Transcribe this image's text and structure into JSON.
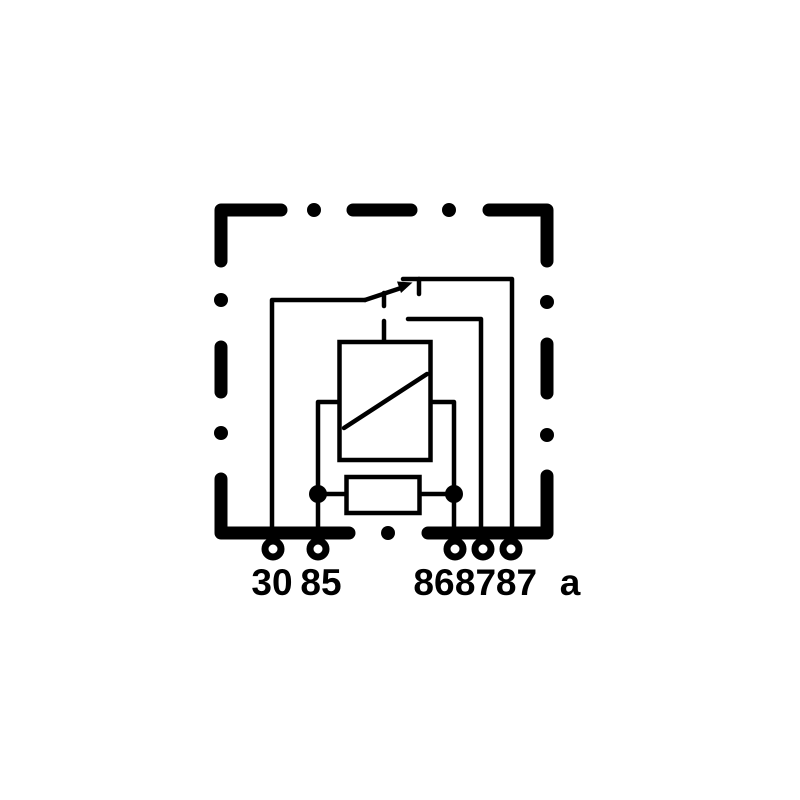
{
  "diagram": {
    "kind": "automotive-relay-wiring-diagram",
    "colors": {
      "line": "#000000",
      "background": "#ffffff"
    },
    "components": {
      "housing": "dashed-relay-housing-outline",
      "coil": "relay-coil-box-with-diagonal",
      "resistor": "parallel-resistor-box",
      "switch": "changeover-switch-contact",
      "pins": "terminal-pin-rings"
    },
    "terminals": [
      {
        "label": "30"
      },
      {
        "label": "85"
      },
      {
        "label": "86"
      },
      {
        "label": "87"
      },
      {
        "label": "87"
      },
      {
        "label": "a"
      }
    ]
  }
}
